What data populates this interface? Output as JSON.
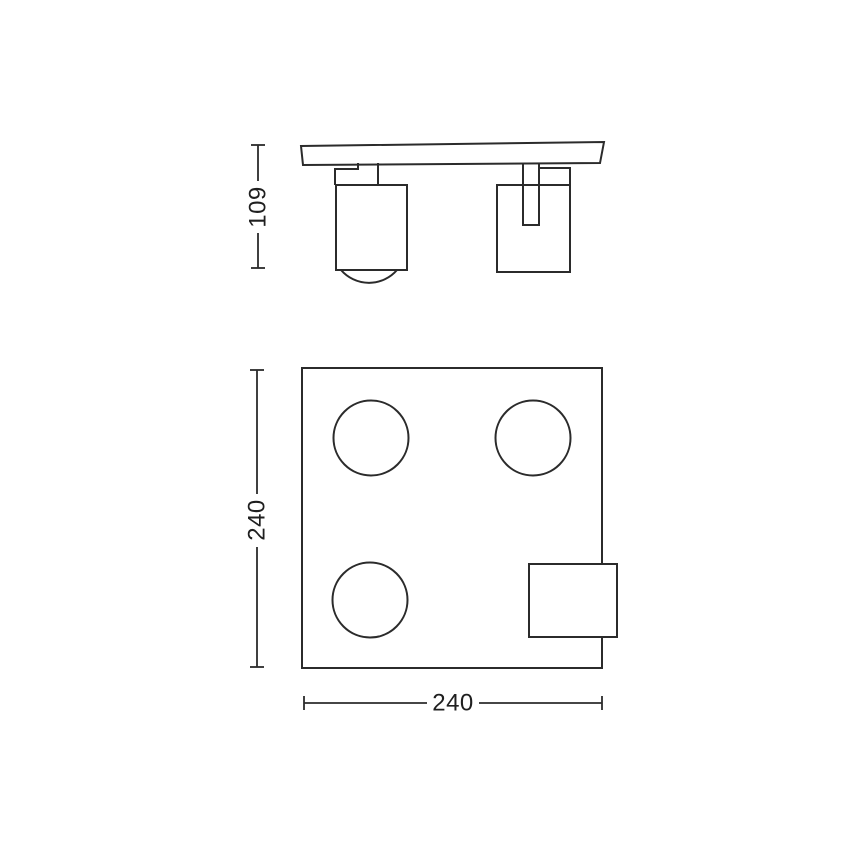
{
  "colors": {
    "background": "#ffffff",
    "line": "#2b2b2b",
    "text": "#1f1f1f"
  },
  "side_view": {
    "height_dimension_label": "109"
  },
  "plan_view": {
    "height_dimension_label": "240",
    "width_dimension_label": "240"
  }
}
